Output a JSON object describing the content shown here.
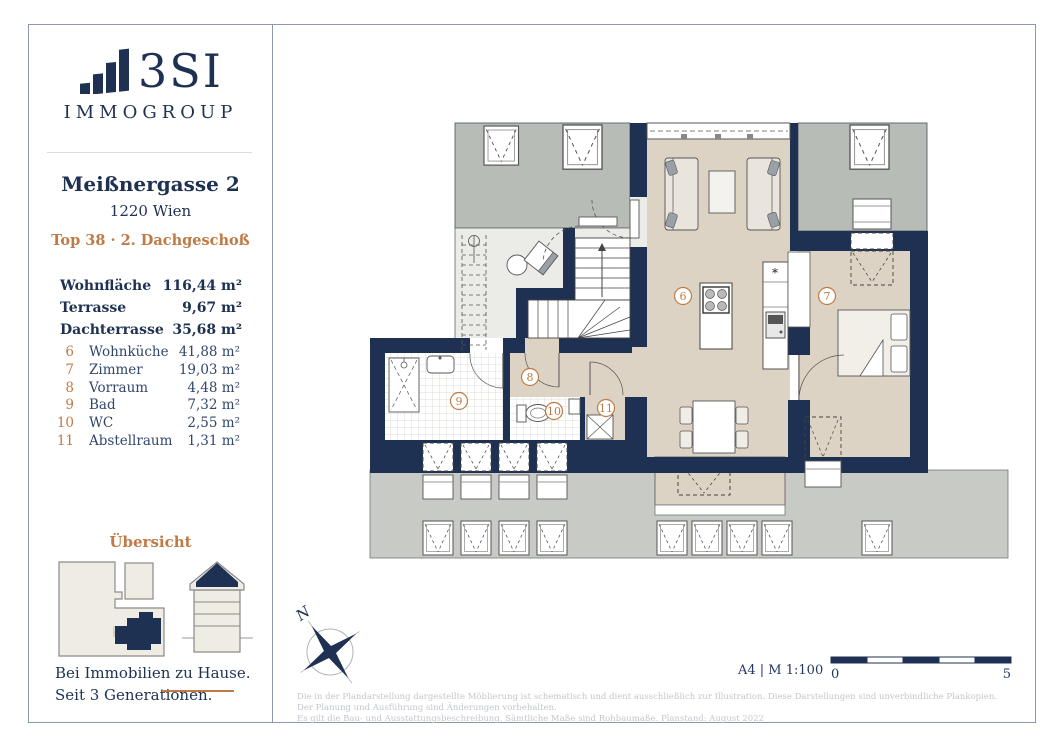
{
  "sidebar": {
    "logo": {
      "brand": "3SI",
      "subbrand": "IMMOGROUP"
    },
    "address_line1": "Meißnergasse 2",
    "address_line2": "1220 Wien",
    "unit_line": "Top 38 · 2. Dachgeschoß",
    "summary": [
      {
        "label": "Wohnfläche",
        "value": "116,44 m²"
      },
      {
        "label": "Terrasse",
        "value": "9,67 m²"
      },
      {
        "label": "Dachterrasse",
        "value": "35,68 m²"
      }
    ],
    "rooms": [
      {
        "no": "6",
        "name": "Wohnküche",
        "area": "41,88 m²"
      },
      {
        "no": "7",
        "name": "Zimmer",
        "area": "19,03 m²"
      },
      {
        "no": "8",
        "name": "Vorraum",
        "area": "4,48 m²"
      },
      {
        "no": "9",
        "name": "Bad",
        "area": "7,32 m²"
      },
      {
        "no": "10",
        "name": "WC",
        "area": "2,55 m²"
      },
      {
        "no": "11",
        "name": "Abstellraum",
        "area": "1,31 m²"
      }
    ],
    "overview_title": "Übersicht",
    "tagline_line1": "Bei Immobilien zu Hause.",
    "tagline_line2": "Seit 3 Generationen."
  },
  "plan": {
    "room_labels": [
      "6",
      "7",
      "8",
      "9",
      "10",
      "11"
    ],
    "north_label": "N",
    "kitchen_marker": "*",
    "scale_text": "A4 | M 1:100",
    "scalebar": {
      "start": "0",
      "end": "5"
    }
  },
  "footer": {
    "disclaimer_line1": "Die in der Plandarstellung dargestellte Möblierung ist schematisch und dient ausschließlich zur Illustration. Diese Darstellungen sind unverbindliche Plankopien. Der Planung und Ausführung sind Änderungen vorbehalten.",
    "disclaimer_line2": "Es gilt die Bau- und Ausstattungsbeschreibung. Sämtliche Maße sind Rohbaumaße. Planstand: August 2022"
  },
  "colors": {
    "navy": "#1e3152",
    "orange": "#bf7a45",
    "beige": "#ddd3c5",
    "terrace_gray": "#b8bcb7",
    "roof_gray": "#c7cac5"
  }
}
